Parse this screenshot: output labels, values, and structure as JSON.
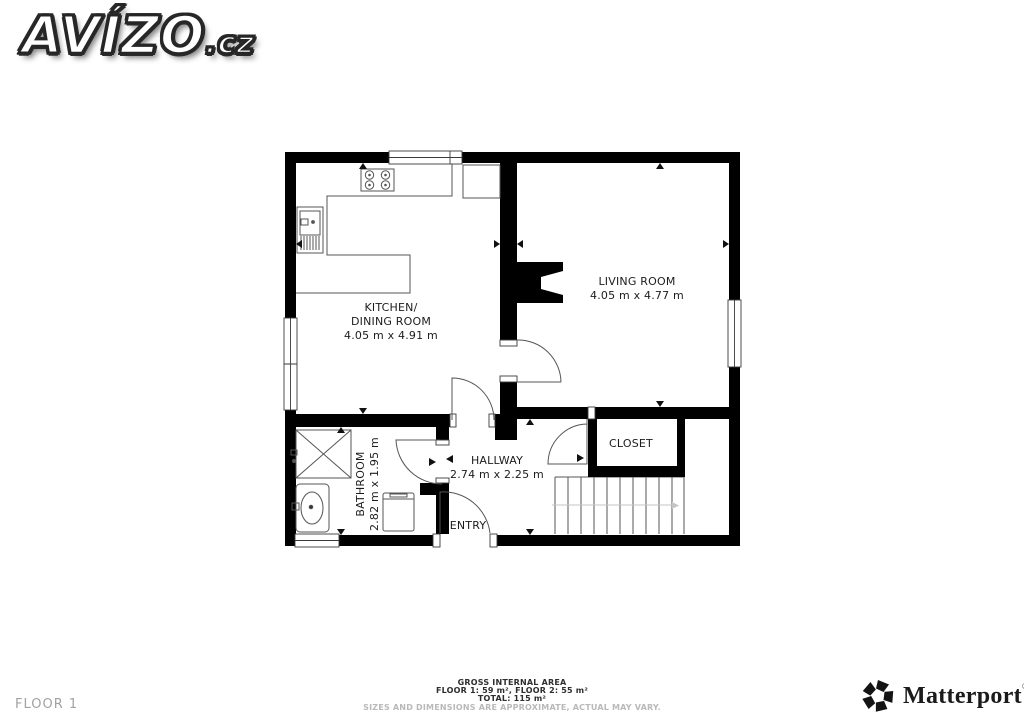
{
  "branding": {
    "site": "AVÍZO",
    "site_tld": ".cz",
    "provider": "Matterport",
    "provider_reg": "®"
  },
  "icons": {
    "provider_icon": "matterport-pinwheel-icon"
  },
  "floor_label": "FLOOR 1",
  "rooms": {
    "kitchen": {
      "line1": "KITCHEN/",
      "line2": "DINING ROOM",
      "dims": "4.05 m x 4.91 m"
    },
    "living": {
      "name": "LIVING ROOM",
      "dims": "4.05 m x 4.77 m"
    },
    "bathroom": {
      "name": "BATHROOM",
      "dims": "2.82 m x 1.95 m"
    },
    "hallway": {
      "name": "HALLWAY",
      "dims": "2.74 m x 2.25 m"
    },
    "closet": {
      "name": "CLOSET"
    },
    "entry": {
      "name": "ENTRY"
    }
  },
  "footer": {
    "title": "GROSS INTERNAL AREA",
    "floors": "FLOOR 1: 59 m², FLOOR 2: 55 m²",
    "total": "TOTAL: 115 m²",
    "disclaimer": "SIZES AND DIMENSIONS ARE APPROXIMATE, ACTUAL MAY VARY."
  },
  "colors": {
    "wall": "#000000",
    "thin_line": "#555555",
    "muted_text": "#a2a2a2",
    "label_text": "#1c1c1c"
  }
}
